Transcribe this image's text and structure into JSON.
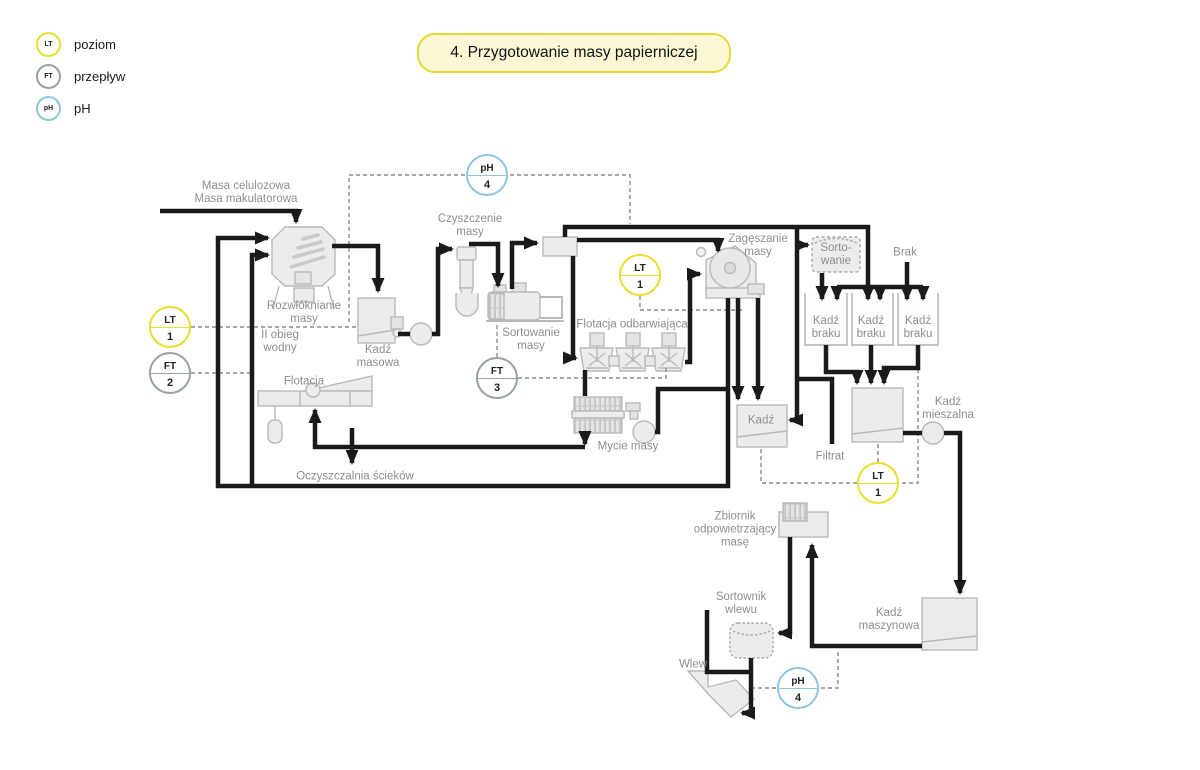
{
  "title": "4. Przygotowanie masy papierniczej",
  "legend": {
    "items": [
      {
        "tag": "LT",
        "label": "poziom"
      },
      {
        "tag": "FT",
        "label": "przepływ"
      },
      {
        "tag": "pH",
        "label": "pH"
      }
    ]
  },
  "colors": {
    "level_yellow": "#e8df2f",
    "flow_gray": "#9aa39c",
    "ph_blue": "#8fc6de",
    "line_black": "#1a1a1a",
    "equipment_fill": "#ececec",
    "equipment_stroke": "#b9b9b9",
    "label_gray": "#8e8e8e"
  },
  "instruments": {
    "lt1_left": {
      "tag": "LT",
      "num": "1"
    },
    "ft2": {
      "tag": "FT",
      "num": "2"
    },
    "ph4_top": {
      "tag": "pH",
      "num": "4"
    },
    "lt1_mid": {
      "tag": "LT",
      "num": "1"
    },
    "ft3": {
      "tag": "FT",
      "num": "3"
    },
    "lt1_right": {
      "tag": "LT",
      "num": "1"
    },
    "ph4_bottom": {
      "tag": "pH",
      "num": "4"
    }
  },
  "labels": {
    "feed": {
      "l1": "Masa celulozowa",
      "l2": "Masa makulatorowa"
    },
    "pulper": {
      "l1": "Rozwłóknianie",
      "l2": "masy"
    },
    "water_loop": {
      "l1": "II obieg",
      "l2": "wodny"
    },
    "kadz_masowa": {
      "l1": "Kadź",
      "l2": "masowa"
    },
    "czyszczenie": {
      "l1": "Czyszczenie",
      "l2": "masy"
    },
    "sortowanie_masy": {
      "l1": "Sortowanie",
      "l2": "masy"
    },
    "flotacja_odb": {
      "l1": "Flotacja odbarwiająca"
    },
    "zageszczanie": {
      "l1": "Zagęszanie",
      "l2": "masy"
    },
    "sorto_box": {
      "l1": "Sorto-",
      "l2": "wanie"
    },
    "brak": {
      "l1": "Brak"
    },
    "kadz_braku": {
      "l1": "Kadź",
      "l2": "braku"
    },
    "kadz_mieszalna": {
      "l1": "Kadź",
      "l2": "mieszalna"
    },
    "filtrat": {
      "l1": "Filtrat"
    },
    "flotacja": {
      "l1": "Flotacja"
    },
    "oczyszczalnia": {
      "l1": "Oczyszczalnia ścieków"
    },
    "mycie": {
      "l1": "Mycie masy"
    },
    "kadz": {
      "l1": "Kadź"
    },
    "zbiornik_odp": {
      "l1": "Zbiornik",
      "l2": "odpowietrzający",
      "l3": "masę"
    },
    "sortownik": {
      "l1": "Sortownik",
      "l2": "wlewu"
    },
    "wlew": {
      "l1": "Wlew"
    },
    "kadz_maszynowa": {
      "l1": "Kadź",
      "l2": "maszynowa"
    }
  }
}
